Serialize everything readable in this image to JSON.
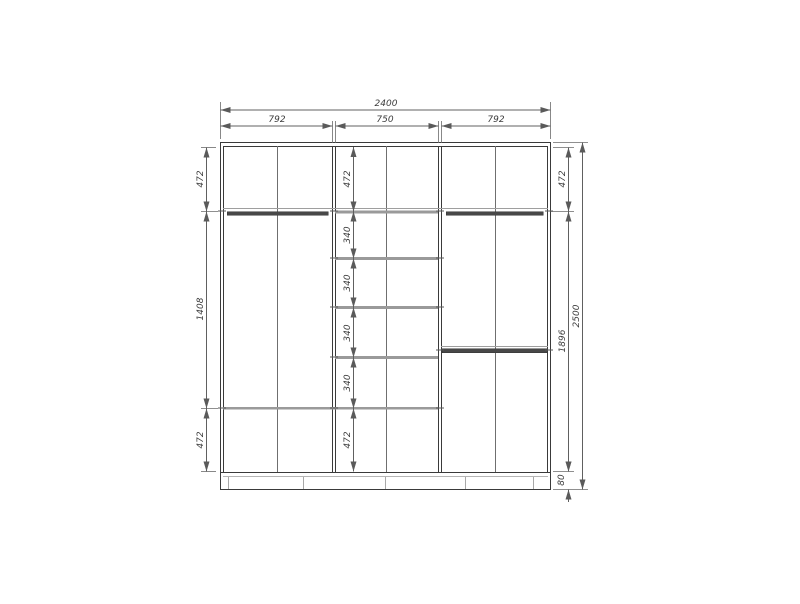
{
  "drawing": {
    "dims": {
      "overall_width": "2400",
      "overall_height": "2500",
      "top_sections": [
        "792",
        "750",
        "792"
      ],
      "left_column": [
        "472",
        "1408",
        "472"
      ],
      "center_column": [
        "472",
        "340",
        "340",
        "340",
        "340",
        "472"
      ],
      "right_column": [
        "472",
        "1896",
        "80"
      ]
    },
    "colors": {
      "background": "#ffffff",
      "body_line": "#3a3a3a",
      "shelf": "#9a9a9a",
      "rod": "#484848",
      "dimension": "#606060",
      "text": "#3c3c3c"
    }
  }
}
